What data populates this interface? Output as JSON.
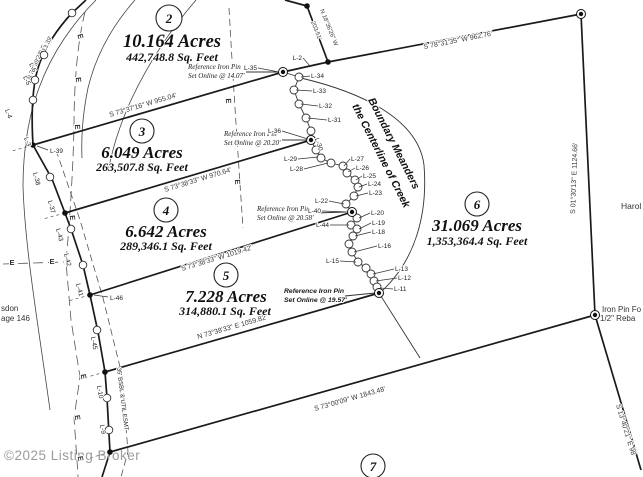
{
  "watermark": "©2025 Listing Broker",
  "lots": [
    {
      "num": "2",
      "acres": "10.164 Acres",
      "sqft": "442,748.8 Sq. Feet"
    },
    {
      "num": "3",
      "acres": "6.049 Acres",
      "sqft": "263,507.8 Sq. Feet"
    },
    {
      "num": "4",
      "acres": "6.642 Acres",
      "sqft": "289,346.1 Sq. Feet"
    },
    {
      "num": "5",
      "acres": "7.228 Acres",
      "sqft": "314,880.1 Sq. Feet"
    },
    {
      "num": "6",
      "acres": "31.069 Acres",
      "sqft": "1,353,364.4 Sq. Feet"
    },
    {
      "num": "7"
    }
  ],
  "bearings": [
    {
      "text": "S 73°37'16\" W 955.04'"
    },
    {
      "text": "S 78°31'35\" W 962.76'"
    },
    {
      "text": "N 18°36'26\" W",
      "dist": "203.51'"
    },
    {
      "text": "S 01°30'13\" E 1124.66'"
    },
    {
      "text": "S 73°38'33\" W 970.64'"
    },
    {
      "text": "S 73°38'33\" W 1019.42'"
    },
    {
      "text": "N 73°38'33\" E 1059.82'"
    },
    {
      "text": "S 73°00'09\" W 1843.48'"
    },
    {
      "text": "S 13°40'21\" E 98"
    },
    {
      "text": "N 31°39'27\" E",
      "dist": "213.39'"
    }
  ],
  "pin_notes": [
    {
      "line1": "Reference Iron Pin",
      "line2": "Set Online @ 14.07'"
    },
    {
      "line1": "Reference Iron Pin",
      "line2": "Set Online @ 20.20'"
    },
    {
      "line1": "Reference Iron Pin",
      "line2": "Set Online @ 20.58'"
    },
    {
      "line1": "Reference Iron Pin",
      "line2": "Set Online @ 19.57'"
    }
  ],
  "creek_note": {
    "line1": "Boundary Meanders",
    "line2": "the Centerline of Creek"
  },
  "easement_label": "35' BSBL & UTIL ESMT",
  "corner_texts": {
    "found1": "Iron Pin Fo",
    "found2": "1/2\" Reba",
    "name": "Harol",
    "deed1": "sdon",
    "deed2": "age 146"
  },
  "utility": {
    "glyph": "E",
    "markers": [
      {
        "x": 78,
        "y": 37,
        "r": 75
      },
      {
        "x": 76,
        "y": 80,
        "r": 85
      },
      {
        "x": 75,
        "y": 127,
        "r": 88
      },
      {
        "x": 70,
        "y": 218,
        "r": 85
      },
      {
        "x": 12,
        "y": 265,
        "r": 0
      },
      {
        "x": 52,
        "y": 264,
        "r": 0
      },
      {
        "x": 81,
        "y": 377,
        "r": 80
      },
      {
        "x": 75,
        "y": 418,
        "r": 80
      },
      {
        "x": 78,
        "y": 459,
        "r": 80
      },
      {
        "x": 226,
        "y": 101,
        "r": 88
      },
      {
        "x": 235,
        "y": 182,
        "r": 88
      }
    ]
  },
  "creek": {
    "pts": [
      [
        283,
        72
      ],
      [
        299,
        77
      ],
      [
        294,
        90
      ],
      [
        299,
        104
      ],
      [
        306,
        118
      ],
      [
        311,
        131
      ],
      [
        311,
        140
      ],
      [
        316,
        150
      ],
      [
        321,
        158
      ],
      [
        331,
        163
      ],
      [
        343,
        166
      ],
      [
        347,
        173
      ],
      [
        355,
        180
      ],
      [
        358,
        187
      ],
      [
        354,
        196
      ],
      [
        346,
        204
      ],
      [
        352,
        212
      ],
      [
        357,
        218
      ],
      [
        351,
        225
      ],
      [
        357,
        229
      ],
      [
        353,
        236
      ],
      [
        349,
        244
      ],
      [
        352,
        252
      ],
      [
        358,
        262
      ],
      [
        366,
        268
      ],
      [
        371,
        274
      ],
      [
        374,
        281
      ],
      [
        377,
        287
      ],
      [
        379,
        293
      ]
    ],
    "labels": [
      {
        "t": "L-2",
        "x": 302,
        "y": 60,
        "p": [
          310,
          66
        ],
        "side": "L"
      },
      {
        "t": "L-35",
        "x": 257,
        "y": 70,
        "p": [
          279,
          72
        ],
        "side": "L"
      },
      {
        "t": "L-34",
        "x": 311,
        "y": 78,
        "p": [
          301,
          77
        ],
        "side": "R"
      },
      {
        "t": "L-33",
        "x": 313,
        "y": 93,
        "p": [
          296,
          90
        ],
        "side": "R"
      },
      {
        "t": "L-32",
        "x": 319,
        "y": 108,
        "p": [
          301,
          104
        ],
        "side": "R"
      },
      {
        "t": "L-31",
        "x": 328,
        "y": 122,
        "p": [
          308,
          118
        ],
        "side": "R"
      },
      {
        "t": "L-36",
        "x": 281,
        "y": 133,
        "p": [
          308,
          139
        ],
        "side": "L"
      },
      {
        "t": "L-30",
        "x": 317,
        "y": 145,
        "rot": 70
      },
      {
        "t": "L-29",
        "x": 297,
        "y": 161,
        "p": [
          318,
          157
        ],
        "side": "L"
      },
      {
        "t": "L-28",
        "x": 303,
        "y": 171,
        "p": [
          328,
          163
        ],
        "side": "L"
      },
      {
        "t": "L-27",
        "x": 351,
        "y": 161,
        "p": [
          344,
          166
        ],
        "side": "R"
      },
      {
        "t": "L-26",
        "x": 356,
        "y": 170,
        "p": [
          348,
          172
        ],
        "side": "R"
      },
      {
        "t": "L-25",
        "x": 363,
        "y": 178,
        "p": [
          356,
          180
        ],
        "side": "R"
      },
      {
        "t": "L-24",
        "x": 368,
        "y": 186,
        "p": [
          359,
          187
        ],
        "side": "R"
      },
      {
        "t": "L-23",
        "x": 369,
        "y": 195,
        "p": [
          356,
          196
        ],
        "side": "R"
      },
      {
        "t": "L-22",
        "x": 328,
        "y": 203,
        "p": [
          344,
          204
        ],
        "side": "L"
      },
      {
        "t": "L-40",
        "x": 321,
        "y": 213,
        "p": [
          348,
          212
        ],
        "side": "L"
      },
      {
        "t": "L-20",
        "x": 371,
        "y": 215,
        "p": [
          359,
          218
        ],
        "side": "R"
      },
      {
        "t": "L-44",
        "x": 329,
        "y": 227,
        "p": [
          349,
          225
        ],
        "side": "L"
      },
      {
        "t": "L-19",
        "x": 372,
        "y": 225,
        "p": [
          359,
          229
        ],
        "side": "R"
      },
      {
        "t": "L-18",
        "x": 372,
        "y": 234,
        "p": [
          355,
          236
        ],
        "side": "R"
      },
      {
        "t": "L-16",
        "x": 378,
        "y": 248,
        "p": [
          354,
          252
        ],
        "side": "R"
      },
      {
        "t": "L-15",
        "x": 339,
        "y": 263,
        "p": [
          356,
          262
        ],
        "side": "L"
      },
      {
        "t": "L-13",
        "x": 395,
        "y": 271,
        "p": [
          373,
          274
        ],
        "side": "R"
      },
      {
        "t": "L-12",
        "x": 398,
        "y": 280,
        "p": [
          376,
          281
        ],
        "side": "R"
      },
      {
        "t": "L-11",
        "x": 394,
        "y": 291,
        "p": [
          380,
          288
        ],
        "side": "R"
      }
    ]
  },
  "road_labels": [
    {
      "t": "L-4",
      "x": 5,
      "y": 110,
      "r": 70
    },
    {
      "t": "L-5",
      "x": 23,
      "y": 77,
      "r": 65
    },
    {
      "t": "L-6",
      "x": 29,
      "y": 64,
      "r": 65
    },
    {
      "t": "L-3",
      "x": 24,
      "y": 138,
      "r": 70
    },
    {
      "t": "L-39",
      "x": 50,
      "y": 153,
      "r": 0,
      "leader": [
        48,
        150,
        37,
        146
      ]
    },
    {
      "t": "L-38",
      "x": 33,
      "y": 173,
      "r": 75
    },
    {
      "t": "L-37",
      "x": 48,
      "y": 201,
      "r": 75
    },
    {
      "t": "L-43",
      "x": 56,
      "y": 229,
      "r": 75
    },
    {
      "t": "L-42",
      "x": 64,
      "y": 254,
      "r": 75
    },
    {
      "t": "L-41",
      "x": 76,
      "y": 284,
      "r": 75
    },
    {
      "t": "L-46",
      "x": 110,
      "y": 300,
      "r": 0,
      "leader": [
        108,
        297,
        94,
        295
      ]
    },
    {
      "t": "L-45",
      "x": 91,
      "y": 337,
      "r": 80
    },
    {
      "t": "L-10",
      "x": 97,
      "y": 386,
      "r": 80
    },
    {
      "t": "L-9",
      "x": 100,
      "y": 425,
      "r": 80
    }
  ],
  "markers": {
    "pins": [
      [
        283,
        72
      ],
      [
        311,
        140
      ],
      [
        352,
        212
      ],
      [
        379,
        293
      ],
      [
        581,
        14
      ],
      [
        595,
        315
      ]
    ],
    "dots": [
      [
        328,
        62
      ],
      [
        307,
        6
      ],
      [
        33,
        145
      ],
      [
        65,
        213
      ],
      [
        90,
        295
      ],
      [
        105,
        372
      ],
      [
        110,
        452
      ]
    ],
    "road_circles": [
      [
        72,
        13
      ],
      [
        44,
        55
      ],
      [
        35,
        80
      ],
      [
        33,
        100
      ],
      [
        50,
        177
      ],
      [
        71,
        229
      ],
      [
        83,
        265
      ],
      [
        97,
        330
      ],
      [
        107,
        398
      ],
      [
        109,
        430
      ]
    ]
  }
}
